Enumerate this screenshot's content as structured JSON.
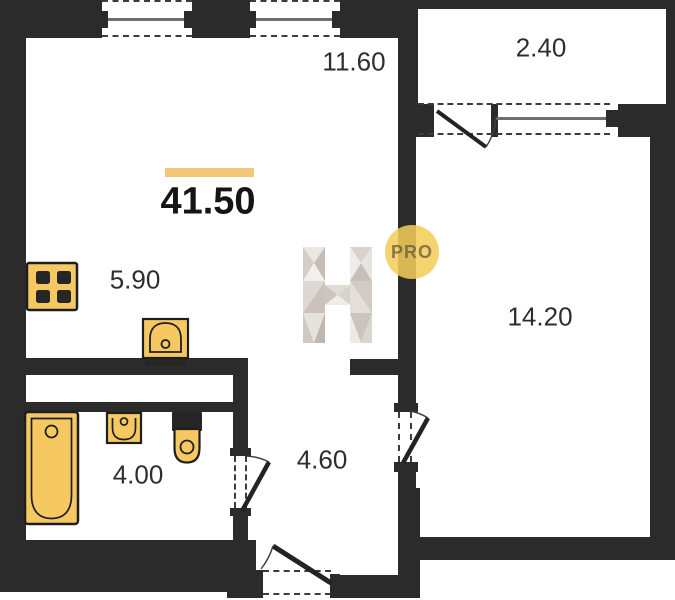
{
  "plan": {
    "total_area": "41.50",
    "rooms": {
      "kitchen_living": "11.60",
      "balcony": "2.40",
      "kitchen_zone": "5.90",
      "bedroom": "14.20",
      "bathroom": "4.00",
      "hallway": "4.60"
    },
    "watermark": {
      "badge": "PRO",
      "logo": "faceted-letter-H"
    },
    "colors": {
      "wall": "#2b2b2b",
      "fixture_fill": "#f6c861",
      "accent_bar": "#f1c878",
      "badge_fill": "#f3cd5c"
    },
    "fixtures": [
      "stove-icon",
      "kitchen-sink-icon",
      "bathtub-icon",
      "washbasin-icon",
      "toilet-icon"
    ],
    "openings": [
      "window",
      "window",
      "balcony-door",
      "balcony-window",
      "bedroom-door",
      "bathroom-door",
      "entrance-door"
    ]
  }
}
